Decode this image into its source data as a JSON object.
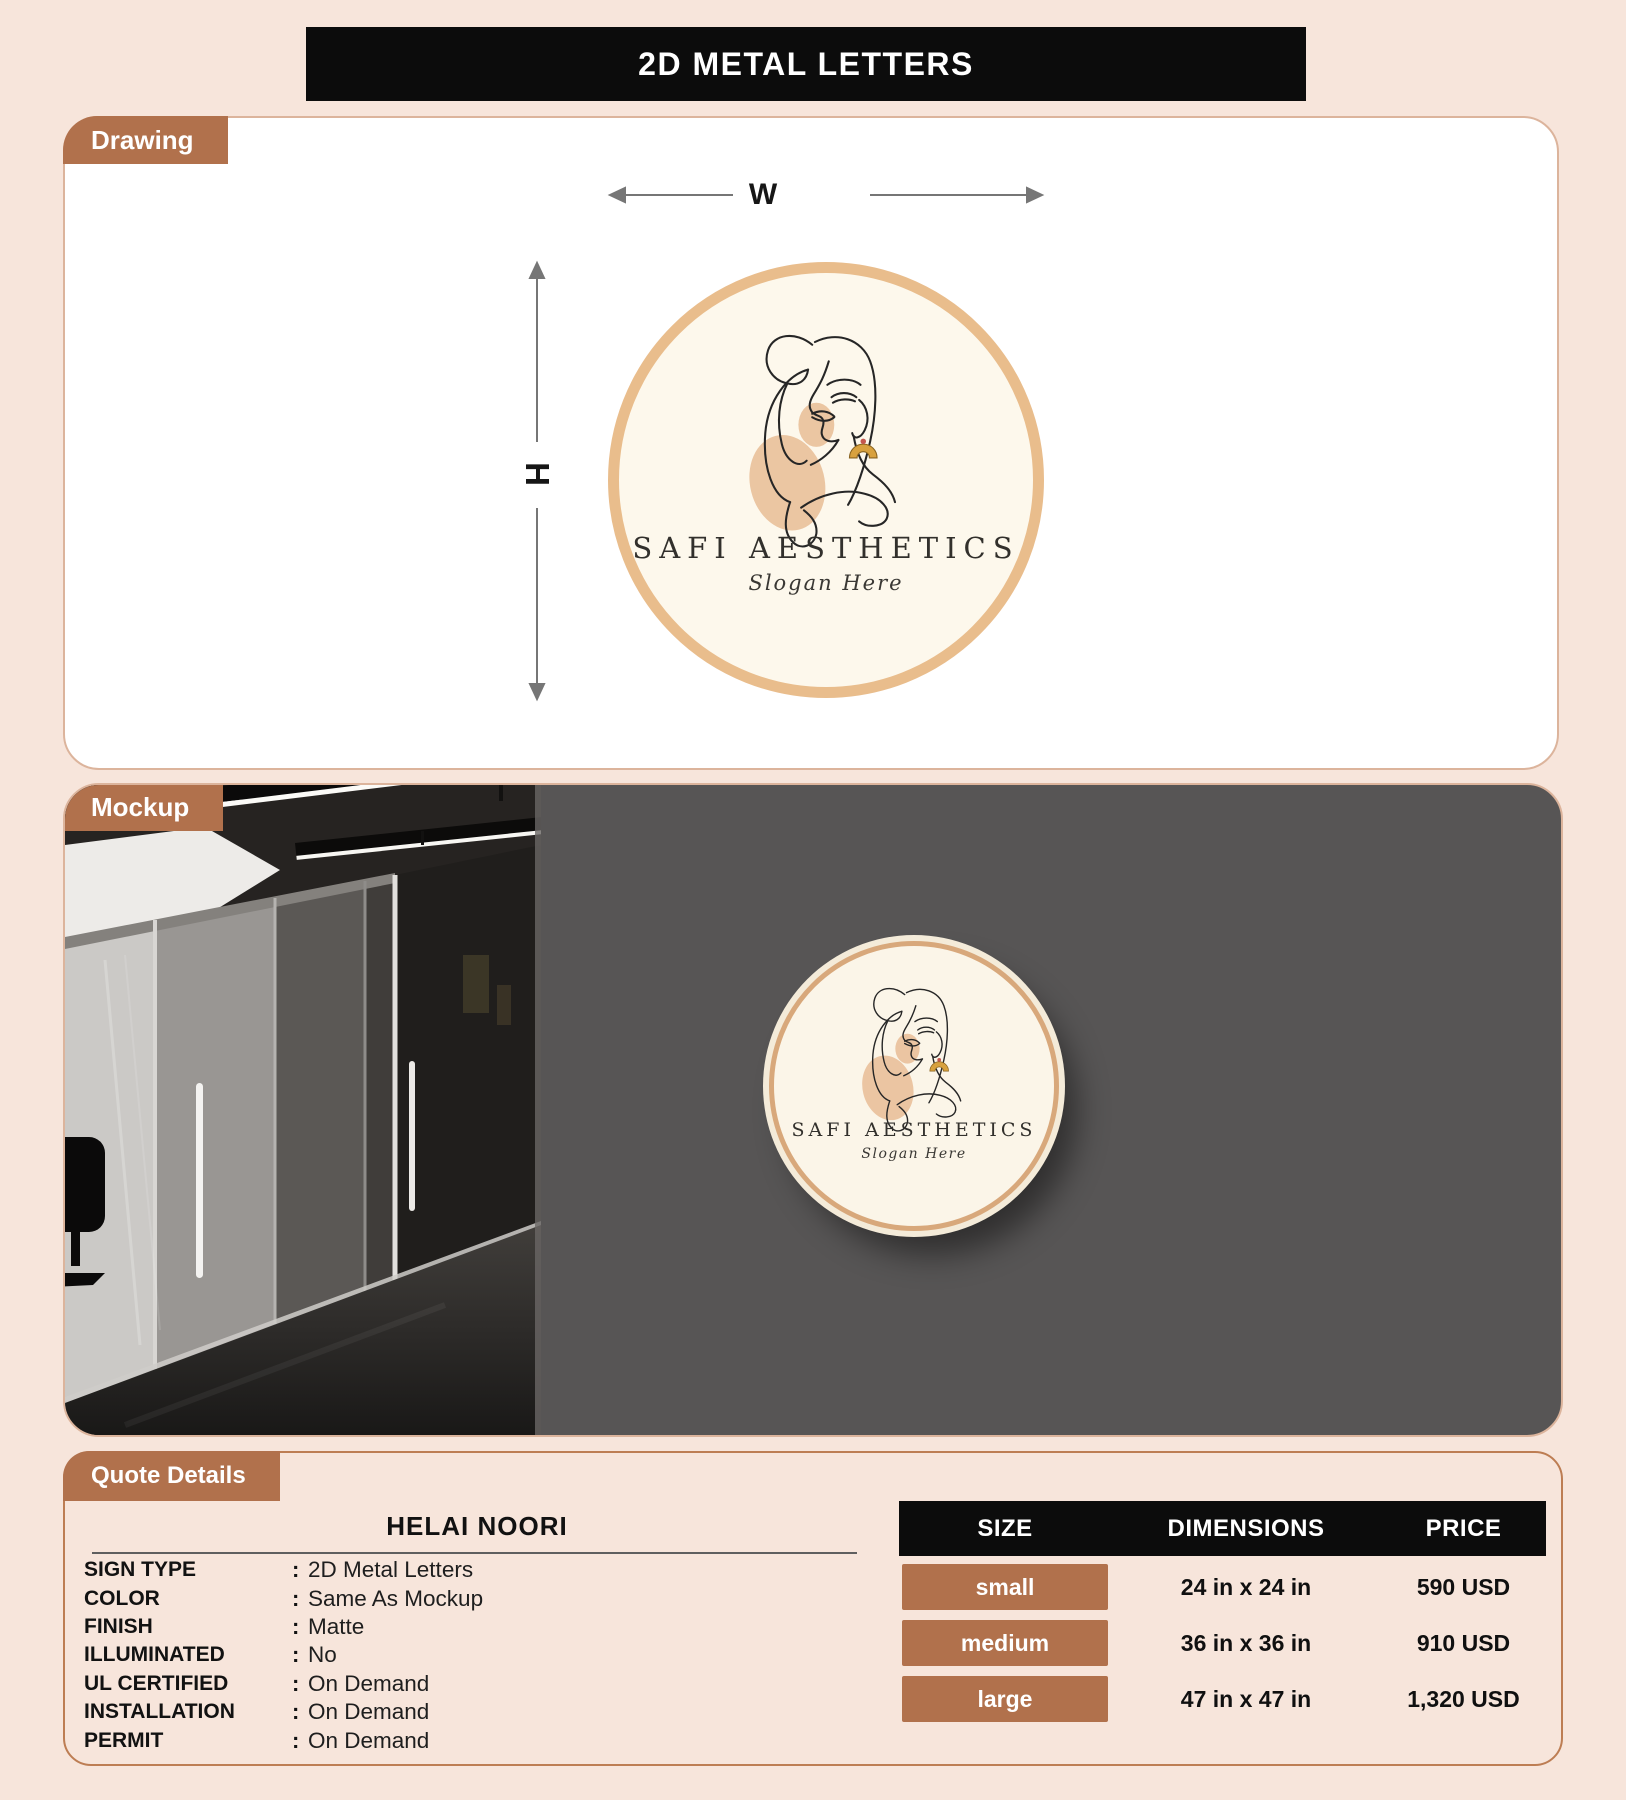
{
  "page": {
    "title": "2D METAL LETTERS"
  },
  "colors": {
    "page_bg": "#f7e5db",
    "accent_brown": "#b1714c",
    "banner_black": "#0c0c0c",
    "circle_border": "#e9bd8c",
    "logo_bg": "#fdf8ec",
    "mockup_wall": "#575555"
  },
  "drawing": {
    "tab_label": "Drawing",
    "width_label": "W",
    "height_label": "H"
  },
  "logo": {
    "brand": "SAFI AESTHETICS",
    "slogan": "Slogan Here"
  },
  "mockup": {
    "tab_label": "Mockup"
  },
  "quote": {
    "tab_label": "Quote Details",
    "customer_name": "HELAI NOORI",
    "separator": ":",
    "details": [
      {
        "label": "SIGN TYPE",
        "value": "2D Metal Letters"
      },
      {
        "label": "COLOR",
        "value": "Same As Mockup"
      },
      {
        "label": "FINISH",
        "value": "Matte"
      },
      {
        "label": "ILLUMINATED",
        "value": "No"
      },
      {
        "label": "UL CERTIFIED",
        "value": "On Demand"
      },
      {
        "label": "INSTALLATION",
        "value": "On Demand"
      },
      {
        "label": "PERMIT",
        "value": "On Demand"
      }
    ],
    "table": {
      "headers": [
        "SIZE",
        "DIMENSIONS",
        "PRICE"
      ],
      "rows": [
        {
          "size": "small",
          "dimensions": "24 in x 24 in",
          "price": "590 USD"
        },
        {
          "size": "medium",
          "dimensions": "36 in x 36 in",
          "price": "910 USD"
        },
        {
          "size": "large",
          "dimensions": "47 in x 47 in",
          "price": "1,320 USD"
        }
      ]
    }
  }
}
